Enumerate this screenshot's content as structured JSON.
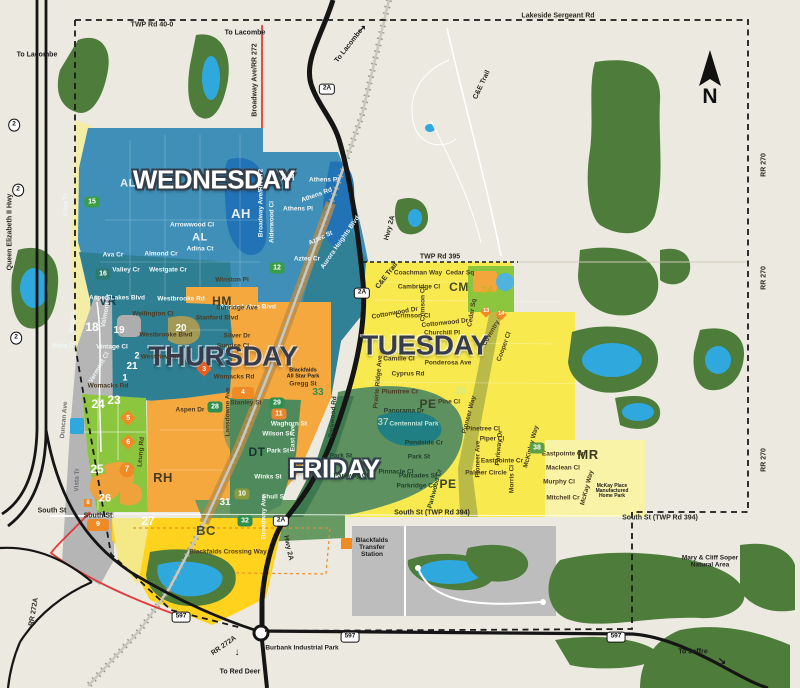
{
  "map": {
    "compass": {
      "label": "N"
    },
    "colors": {
      "background": "#ECEAE0",
      "wednesday": "#3F8FB8",
      "wednesday_dark": "#2F7F93",
      "thursday": "#F5A83E",
      "tuesday": "#F7E94E",
      "tuesday_pale": "#F8F3A6",
      "friday": "#5E9160",
      "friday_dark": "#3E7A50",
      "forest": "#4E7C3B",
      "lake": "#2FA8DE",
      "town_lake": "#2273B6",
      "gray_zone": "#B5B5B5",
      "green_zone": "#8CC63F",
      "bc_yellow": "#FFD21E",
      "badge_orange": "#F08A24",
      "road_black": "#151515",
      "boundary_dash": "#1a1a1a",
      "red_road": "#E03A3A"
    },
    "day_zones": [
      {
        "t": "WEDNESDAY",
        "x": 214,
        "y": 180,
        "k": "light",
        "s": 26
      },
      {
        "t": "THURSDAY",
        "x": 223,
        "y": 356,
        "k": "dark",
        "s": 28
      },
      {
        "t": "TUESDAY",
        "x": 425,
        "y": 345,
        "k": "dark",
        "s": 28
      },
      {
        "t": "FRIDAY",
        "x": 334,
        "y": 469,
        "k": "light",
        "s": 26
      }
    ],
    "area_codes": [
      {
        "t": "AH",
        "x": 288,
        "y": 178,
        "c": "#E8F2F6",
        "s": 9
      },
      {
        "t": "AH",
        "x": 241,
        "y": 214,
        "c": "#E8F2F6",
        "s": 13
      },
      {
        "t": "AL",
        "x": 128,
        "y": 184,
        "c": "#E8F2F6",
        "s": 11
      },
      {
        "t": "AL",
        "x": 200,
        "y": 238,
        "c": "#E8F2F6",
        "s": 11
      },
      {
        "t": "VR",
        "x": 108,
        "y": 301,
        "c": "#163F50",
        "s": 12
      },
      {
        "t": "HM",
        "x": 222,
        "y": 301,
        "c": "#4A3B1F",
        "s": 12
      },
      {
        "t": "CM",
        "x": 459,
        "y": 287,
        "c": "#4A4A22",
        "s": 12
      },
      {
        "t": "PE",
        "x": 428,
        "y": 404,
        "c": "#37422A",
        "s": 12
      },
      {
        "t": "PE",
        "x": 448,
        "y": 484,
        "c": "#37422A",
        "s": 12
      },
      {
        "t": "DT",
        "x": 257,
        "y": 452,
        "c": "#17332B",
        "s": 12
      },
      {
        "t": "RH",
        "x": 163,
        "y": 478,
        "c": "#4A3B1F",
        "s": 13
      },
      {
        "t": "BC",
        "x": 206,
        "y": 531,
        "c": "#4A4A22",
        "s": 13
      },
      {
        "t": "MR",
        "x": 588,
        "y": 455,
        "c": "#3A3A1E",
        "s": 13
      }
    ],
    "streets": [
      {
        "t": "Vista Tr",
        "x": 67,
        "y": 205,
        "r": -90,
        "c": "#EFF6F8"
      },
      {
        "t": "Aspen Lakes Blvd",
        "x": 117,
        "y": 299,
        "c": "#EFF6F8"
      },
      {
        "t": "Ava Cr",
        "x": 113,
        "y": 256,
        "c": "#EFF6F8"
      },
      {
        "t": "Almond Cr",
        "x": 161,
        "y": 255,
        "c": "#EFF6F8"
      },
      {
        "t": "Valley Cr",
        "x": 126,
        "y": 271,
        "c": "#EFF6F8"
      },
      {
        "t": "Westgate Cr",
        "x": 168,
        "y": 271,
        "c": "#EFF6F8"
      },
      {
        "t": "Westbrooke Rd",
        "x": 181,
        "y": 300,
        "c": "#EFF6F8"
      },
      {
        "t": "Arrowwood Cl",
        "x": 192,
        "y": 226,
        "c": "#EFF6F8"
      },
      {
        "t": "Aspen Lakes Blvd",
        "x": 248,
        "y": 308,
        "c": "#EFF6F8"
      },
      {
        "t": "Adina Ct",
        "x": 200,
        "y": 250,
        "c": "#EFF6F8"
      },
      {
        "t": "Athens Pl",
        "x": 324,
        "y": 181,
        "c": "#EFF6F8"
      },
      {
        "t": "Athens Rd",
        "x": 317,
        "y": 196,
        "r": -20,
        "c": "#EFF6F8"
      },
      {
        "t": "Athens Pl",
        "x": 298,
        "y": 210,
        "c": "#EFF6F8"
      },
      {
        "t": "Aurora Heights Blvd",
        "x": 341,
        "y": 243,
        "r": -55,
        "c": "#EFF6F8"
      },
      {
        "t": "Aztec St",
        "x": 321,
        "y": 239,
        "r": -25,
        "c": "#EFF6F8"
      },
      {
        "t": "Aztec Cr",
        "x": 307,
        "y": 260,
        "c": "#EFF6F8"
      },
      {
        "t": "Alderwood Cl",
        "x": 273,
        "y": 222,
        "r": -90,
        "c": "#EFF6F8"
      },
      {
        "t": "Broadway Ave/RR 272",
        "x": 262,
        "y": 203,
        "r": -90,
        "c": "#EFF6F8"
      },
      {
        "t": "Valmont St",
        "x": 107,
        "y": 311,
        "r": -80,
        "c": "#EFF6F8"
      },
      {
        "t": "Vista Cl",
        "x": 64,
        "y": 347,
        "c": "#EFF6F8"
      },
      {
        "t": "Vintage Cl",
        "x": 112,
        "y": 348,
        "c": "#EFF6F8"
      },
      {
        "t": "Vista Tr",
        "x": 74,
        "y": 322,
        "r": -80,
        "c": "#EFF6F8"
      },
      {
        "t": "Vermont Cl",
        "x": 100,
        "y": 368,
        "r": -60,
        "c": "#EFF6F8"
      },
      {
        "t": "Winston Pl",
        "x": 232,
        "y": 281
      },
      {
        "t": "Sunridge Ave",
        "x": 237,
        "y": 309
      },
      {
        "t": "Stanford Blvd",
        "x": 217,
        "y": 319
      },
      {
        "t": "Silver Dr",
        "x": 237,
        "y": 337
      },
      {
        "t": "Sunrise Cl",
        "x": 233,
        "y": 347
      },
      {
        "t": "Womacks Rd",
        "x": 234,
        "y": 378
      },
      {
        "t": "Womacks Rd",
        "x": 108,
        "y": 387
      },
      {
        "t": "Gregg St",
        "x": 303,
        "y": 385
      },
      {
        "t": "Stanley St",
        "x": 246,
        "y": 404
      },
      {
        "t": "Aspen Dr",
        "x": 190,
        "y": 411
      },
      {
        "t": "Wellington Cl",
        "x": 153,
        "y": 315
      },
      {
        "t": "Westbrooke Blvd",
        "x": 166,
        "y": 336
      },
      {
        "t": "Westview Cr",
        "x": 160,
        "y": 358
      },
      {
        "t": "Lansdowne Ave",
        "x": 229,
        "y": 412,
        "r": -90
      },
      {
        "t": "Leung Rd",
        "x": 142,
        "y": 452,
        "r": -85
      },
      {
        "t": "Coachman Way",
        "x": 418,
        "y": 274
      },
      {
        "t": "Cedar Sq",
        "x": 460,
        "y": 274
      },
      {
        "t": "Cambridge Cl",
        "x": 419,
        "y": 288
      },
      {
        "t": "Crimson Cl",
        "x": 424,
        "y": 304,
        "r": -90
      },
      {
        "t": "Crimson Cl",
        "x": 413,
        "y": 317
      },
      {
        "t": "Cottonwood Dr",
        "x": 395,
        "y": 314,
        "r": -10
      },
      {
        "t": "Cottonwood Dr",
        "x": 445,
        "y": 324,
        "r": -6
      },
      {
        "t": "Cedar Sq",
        "x": 473,
        "y": 313,
        "r": -80
      },
      {
        "t": "Churchill Pl",
        "x": 442,
        "y": 334
      },
      {
        "t": "Coventry Cl",
        "x": 494,
        "y": 330,
        "r": -60
      },
      {
        "t": "Cooper Cl",
        "x": 505,
        "y": 347,
        "r": -70
      },
      {
        "t": "Camille Cl",
        "x": 399,
        "y": 360
      },
      {
        "t": "Ponderosa Ave",
        "x": 448,
        "y": 364
      },
      {
        "t": "Cyprus Rd",
        "x": 408,
        "y": 375
      },
      {
        "t": "Plumtree Cr",
        "x": 400,
        "y": 393
      },
      {
        "t": "Prairie Ridge Ave",
        "x": 379,
        "y": 382,
        "r": -85
      },
      {
        "t": "Pine Cl",
        "x": 449,
        "y": 403
      },
      {
        "t": "Pinetree Cl",
        "x": 483,
        "y": 430
      },
      {
        "t": "Piper Cl",
        "x": 492,
        "y": 440
      },
      {
        "t": "Parkway Dr",
        "x": 500,
        "y": 448,
        "r": -85
      },
      {
        "t": "Pioneer Way",
        "x": 470,
        "y": 415,
        "r": -75
      },
      {
        "t": "Pioneer Ave",
        "x": 479,
        "y": 459,
        "r": -90
      },
      {
        "t": "Eastpointe Cr",
        "x": 502,
        "y": 462
      },
      {
        "t": "Palmer Circle",
        "x": 486,
        "y": 474
      },
      {
        "t": "Morris Cl",
        "x": 513,
        "y": 479,
        "r": -90
      },
      {
        "t": "McKinley Way",
        "x": 532,
        "y": 447,
        "r": -75
      },
      {
        "t": "Eastpointe Cr",
        "x": 563,
        "y": 455
      },
      {
        "t": "Maclean Cl",
        "x": 563,
        "y": 469
      },
      {
        "t": "Murphy Cl",
        "x": 559,
        "y": 483
      },
      {
        "t": "Mitchell Cr",
        "x": 563,
        "y": 499
      },
      {
        "t": "McKay Way",
        "x": 588,
        "y": 488,
        "r": -75
      },
      {
        "t": "Waghorn St",
        "x": 289,
        "y": 425,
        "c": "#EFF6F0"
      },
      {
        "t": "Wilson St",
        "x": 277,
        "y": 435,
        "c": "#EFF6F0"
      },
      {
        "t": "Park St",
        "x": 278,
        "y": 452,
        "c": "#EFF6F0"
      },
      {
        "t": "East Ave",
        "x": 294,
        "y": 438,
        "r": -90,
        "c": "#EFF6F0"
      },
      {
        "t": "Winks St",
        "x": 268,
        "y": 478,
        "c": "#EFF6F0"
      },
      {
        "t": "Shull St",
        "x": 274,
        "y": 498,
        "c": "#EFF6F0"
      },
      {
        "t": "Broadway Ave",
        "x": 265,
        "y": 517,
        "r": -90,
        "c": "#EFF6F0"
      },
      {
        "t": "Panorama Dr",
        "x": 404,
        "y": 412,
        "c": "#20402B"
      },
      {
        "t": "Pondside Cr",
        "x": 424,
        "y": 444,
        "c": "#20402B"
      },
      {
        "t": "Park St",
        "x": 419,
        "y": 458,
        "c": "#20402B"
      },
      {
        "t": "Pinnacle Cl",
        "x": 396,
        "y": 473,
        "c": "#20402B"
      },
      {
        "t": "Palisades St",
        "x": 418,
        "y": 477,
        "c": "#20402B"
      },
      {
        "t": "Parkridge Cr",
        "x": 416,
        "y": 487,
        "c": "#20402B"
      },
      {
        "t": "Parkwood Cr",
        "x": 436,
        "y": 489,
        "r": -75,
        "c": "#20402B"
      },
      {
        "t": "Parkwood Rd",
        "x": 334,
        "y": 417,
        "r": -85,
        "c": "#20402B"
      },
      {
        "t": "Park St",
        "x": 341,
        "y": 457,
        "c": "#20402B"
      },
      {
        "t": "Parkway Cl",
        "x": 351,
        "y": 477,
        "c": "#20402B"
      },
      {
        "t": "Centennial Park",
        "x": 414,
        "y": 425,
        "c": "#BFE3D8"
      },
      {
        "t": "Duncan Ave",
        "x": 65,
        "y": 420,
        "r": -85,
        "c": "#707070"
      },
      {
        "t": "Vista Tr",
        "x": 78,
        "y": 480,
        "r": -88,
        "c": "#707070"
      },
      {
        "t": "Blackfalds Crossing Way",
        "x": 228,
        "y": 553
      }
    ],
    "roads": [
      {
        "t": "TWP Rd 40-0",
        "x": 152,
        "y": 25
      },
      {
        "t": "Lakeside Sergeant Rd",
        "x": 558,
        "y": 16
      },
      {
        "t": "TWP Rd 395",
        "x": 440,
        "y": 257
      },
      {
        "t": "C&E Trail",
        "x": 482,
        "y": 85,
        "r": -65
      },
      {
        "t": "C&E Trail",
        "x": 387,
        "y": 276,
        "r": -52
      },
      {
        "t": "South St",
        "x": 52,
        "y": 511
      },
      {
        "t": "South St",
        "x": 98,
        "y": 516
      },
      {
        "t": "South St (TWP Rd 394)",
        "x": 432,
        "y": 513
      },
      {
        "t": "South St (TWP Rd 394)",
        "x": 660,
        "y": 518
      },
      {
        "t": "RR 270",
        "x": 764,
        "y": 165,
        "r": -90
      },
      {
        "t": "RR 270",
        "x": 764,
        "y": 278,
        "r": -90
      },
      {
        "t": "RR 270",
        "x": 764,
        "y": 460,
        "r": -90
      },
      {
        "t": "Queen Elizabeth II Hwy",
        "x": 10,
        "y": 232,
        "r": -90
      },
      {
        "t": "Broadway Ave/RR 272",
        "x": 255,
        "y": 80,
        "r": -90
      },
      {
        "t": "Hwy 2A",
        "x": 390,
        "y": 228,
        "r": -75
      },
      {
        "t": "Hwy 2A",
        "x": 288,
        "y": 548,
        "r": 78
      },
      {
        "t": "RR 272A",
        "x": 34,
        "y": 612,
        "r": -80
      },
      {
        "t": "RR 272A",
        "x": 224,
        "y": 646,
        "r": -35
      }
    ],
    "pois": [
      {
        "t": "Blackfalds\nTransfer\nStation",
        "x": 372,
        "y": 548
      },
      {
        "t": "Burbank Industrial Park",
        "x": 302,
        "y": 649
      },
      {
        "t": "Mary & Cliff Soper\nNatural Area",
        "x": 710,
        "y": 562
      },
      {
        "t": "Blackfalds\nAll Star Park",
        "x": 303,
        "y": 374,
        "s": 5.5
      },
      {
        "t": "McKay Place\nManufactured\nHome Park",
        "x": 612,
        "y": 492,
        "s": 5
      }
    ],
    "directions": [
      {
        "t": "To Lacombe",
        "x": 37,
        "y": 55
      },
      {
        "t": "↑",
        "x": 37,
        "y": 36,
        "s": 10
      },
      {
        "t": "To Lacombe",
        "x": 245,
        "y": 33
      },
      {
        "t": "↑",
        "x": 262,
        "y": 28,
        "s": 10,
        "c": "#E03A3A"
      },
      {
        "t": "To Lacombe",
        "x": 349,
        "y": 46,
        "r": -52
      },
      {
        "t": "↗",
        "x": 362,
        "y": 30,
        "s": 10
      },
      {
        "t": "To Red Deer",
        "x": 240,
        "y": 672
      },
      {
        "t": "↓",
        "x": 237,
        "y": 653,
        "s": 10
      },
      {
        "t": "To Joffre",
        "x": 693,
        "y": 652
      },
      {
        "t": "↘",
        "x": 722,
        "y": 662,
        "s": 10
      }
    ],
    "badges": [
      {
        "t": "15",
        "x": 92,
        "y": 202,
        "k": "chip",
        "bg": "#3C9C47"
      },
      {
        "t": "12",
        "x": 277,
        "y": 268,
        "k": "chip",
        "bg": "#3C9C47"
      },
      {
        "t": "16",
        "x": 103,
        "y": 274,
        "k": "chip",
        "bg": "#2C7A6E"
      },
      {
        "t": "18",
        "x": 92,
        "y": 327,
        "k": "plain",
        "c": "#FFFFFF",
        "s": 12
      },
      {
        "t": "19",
        "x": 119,
        "y": 331,
        "k": "plain",
        "c": "#FFFFFF",
        "s": 10
      },
      {
        "t": "20",
        "x": 181,
        "y": 329,
        "k": "plain",
        "c": "#FFFFFF",
        "s": 10
      },
      {
        "t": "21",
        "x": 132,
        "y": 367,
        "k": "plain",
        "c": "#FFFFFF",
        "s": 10
      },
      {
        "t": "2",
        "x": 137,
        "y": 356,
        "k": "plain",
        "c": "#FFFFFF",
        "s": 9
      },
      {
        "t": "1",
        "x": 125,
        "y": 378,
        "k": "plain",
        "c": "#FFFFFF",
        "s": 9
      },
      {
        "t": "24",
        "x": 98,
        "y": 404,
        "k": "plain",
        "c": "#FFFFFF",
        "s": 12
      },
      {
        "t": "23",
        "x": 114,
        "y": 400,
        "k": "plain",
        "c": "#FFFFFF",
        "s": 12
      },
      {
        "t": "25",
        "x": 97,
        "y": 469,
        "k": "plain",
        "c": "#FFFFFF",
        "s": 12
      },
      {
        "t": "26",
        "x": 105,
        "y": 499,
        "k": "plain",
        "c": "#FFFFFF",
        "s": 11
      },
      {
        "t": "27",
        "x": 148,
        "y": 521,
        "k": "plain",
        "c": "#FFFFFF",
        "s": 12
      },
      {
        "t": "5",
        "x": 128,
        "y": 418,
        "k": "diamond",
        "r": 45
      },
      {
        "t": "6",
        "x": 128,
        "y": 442,
        "k": "diamond",
        "r": 45
      },
      {
        "t": "7",
        "x": 127,
        "y": 470,
        "k": "circle"
      },
      {
        "t": "8",
        "x": 88,
        "y": 503,
        "k": "sq"
      },
      {
        "t": "9",
        "x": 98,
        "y": 525,
        "k": "chipw"
      },
      {
        "t": "3",
        "x": 204,
        "y": 369,
        "k": "diamond",
        "r": 45,
        "bg": "#E85D1F"
      },
      {
        "t": "4",
        "x": 243,
        "y": 393,
        "k": "chipw"
      },
      {
        "t": "28",
        "x": 215,
        "y": 407,
        "k": "chip",
        "bg": "#2F8F4F"
      },
      {
        "t": "29",
        "x": 277,
        "y": 403,
        "k": "chip",
        "bg": "#2F8F4F"
      },
      {
        "t": "11",
        "x": 279,
        "y": 414,
        "k": "chip",
        "bg": "#E8862D"
      },
      {
        "t": "33",
        "x": 318,
        "y": 393,
        "k": "plain",
        "c": "#2F8F4F",
        "s": 10
      },
      {
        "t": "10",
        "x": 242,
        "y": 494,
        "k": "chip",
        "bg": "#8A9A3C"
      },
      {
        "t": "31",
        "x": 225,
        "y": 503,
        "k": "plain",
        "c": "#FFFFFF",
        "s": 10
      },
      {
        "t": "32",
        "x": 245,
        "y": 521,
        "k": "chip",
        "bg": "#2F8F4F"
      },
      {
        "t": "34",
        "x": 487,
        "y": 291,
        "k": "plain",
        "c": "#C9B41E",
        "s": 11
      },
      {
        "t": "13",
        "x": 486,
        "y": 312,
        "k": "diamond-s",
        "r": 45
      },
      {
        "t": "14",
        "x": 501,
        "y": 315,
        "k": "diamond-s",
        "r": 45
      },
      {
        "t": "36",
        "x": 460,
        "y": 392,
        "k": "plain",
        "c": "#D6E98A",
        "s": 10
      },
      {
        "t": "37",
        "x": 383,
        "y": 423,
        "k": "plain",
        "c": "#AFCCAD",
        "s": 10
      },
      {
        "t": "38",
        "x": 537,
        "y": 448,
        "k": "chip",
        "bg": "#5E9E45"
      }
    ],
    "shields": [
      {
        "t": "2",
        "x": 14,
        "y": 125,
        "k": "oval"
      },
      {
        "t": "2",
        "x": 18,
        "y": 190,
        "k": "oval"
      },
      {
        "t": "2",
        "x": 16,
        "y": 338,
        "k": "oval"
      },
      {
        "t": "2A",
        "x": 327,
        "y": 89
      },
      {
        "t": "2A",
        "x": 362,
        "y": 293
      },
      {
        "t": "2A",
        "x": 281,
        "y": 521
      },
      {
        "t": "597",
        "x": 181,
        "y": 617
      },
      {
        "t": "597",
        "x": 350,
        "y": 637
      },
      {
        "t": "597",
        "x": 616,
        "y": 637
      }
    ]
  }
}
